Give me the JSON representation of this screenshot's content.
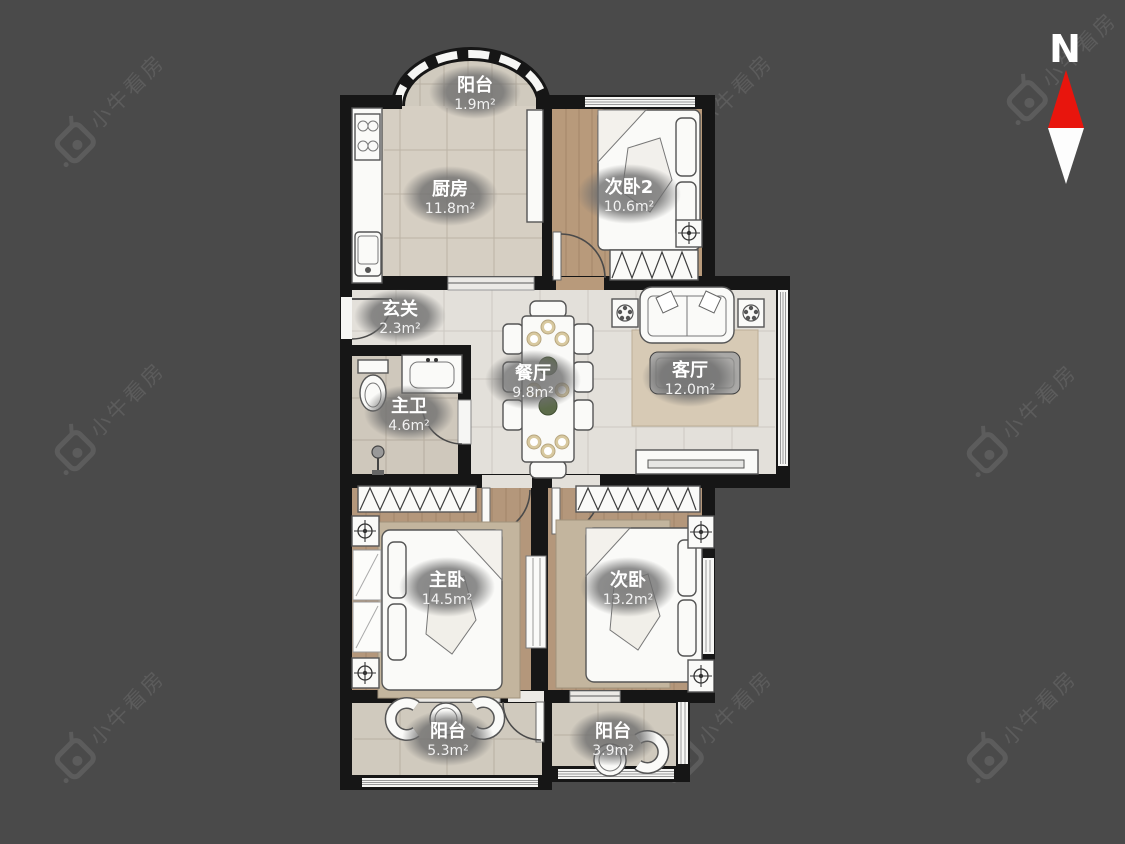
{
  "watermark": {
    "text": "小牛看房",
    "color": "#5c5c5c"
  },
  "compass": {
    "label": "N",
    "needle_north_color": "#e8150d",
    "needle_south_color": "#fdfdfd"
  },
  "rooms": [
    {
      "id": "balcony-top",
      "name": "阳台",
      "area": "1.9m²"
    },
    {
      "id": "kitchen",
      "name": "厨房",
      "area": "11.8m²"
    },
    {
      "id": "bedroom2",
      "name": "次卧2",
      "area": "10.6m²"
    },
    {
      "id": "entry",
      "name": "玄关",
      "area": "2.3m²"
    },
    {
      "id": "master-bath",
      "name": "主卫",
      "area": "4.6m²"
    },
    {
      "id": "dining",
      "name": "餐厅",
      "area": "9.8m²"
    },
    {
      "id": "living",
      "name": "客厅",
      "area": "12.0m²"
    },
    {
      "id": "master-bedroom",
      "name": "主卧",
      "area": "14.5m²"
    },
    {
      "id": "bedroom",
      "name": "次卧",
      "area": "13.2m²"
    },
    {
      "id": "balcony-left",
      "name": "阳台",
      "area": "5.3m²"
    },
    {
      "id": "balcony-right",
      "name": "阳台",
      "area": "3.9m²"
    }
  ],
  "palette": {
    "background": "#4a4a4a",
    "wall": "#161616",
    "wood_floor": "#b59879",
    "kitchen_tile": "#d6cfc3",
    "marble_floor": "#e3e0da",
    "bath_tile": "#cfc8bc",
    "balcony_tile": "#d0cabe",
    "furniture": "#fafaf8",
    "label_badge": "#6e6e6e",
    "label_text": "#ffffff"
  }
}
